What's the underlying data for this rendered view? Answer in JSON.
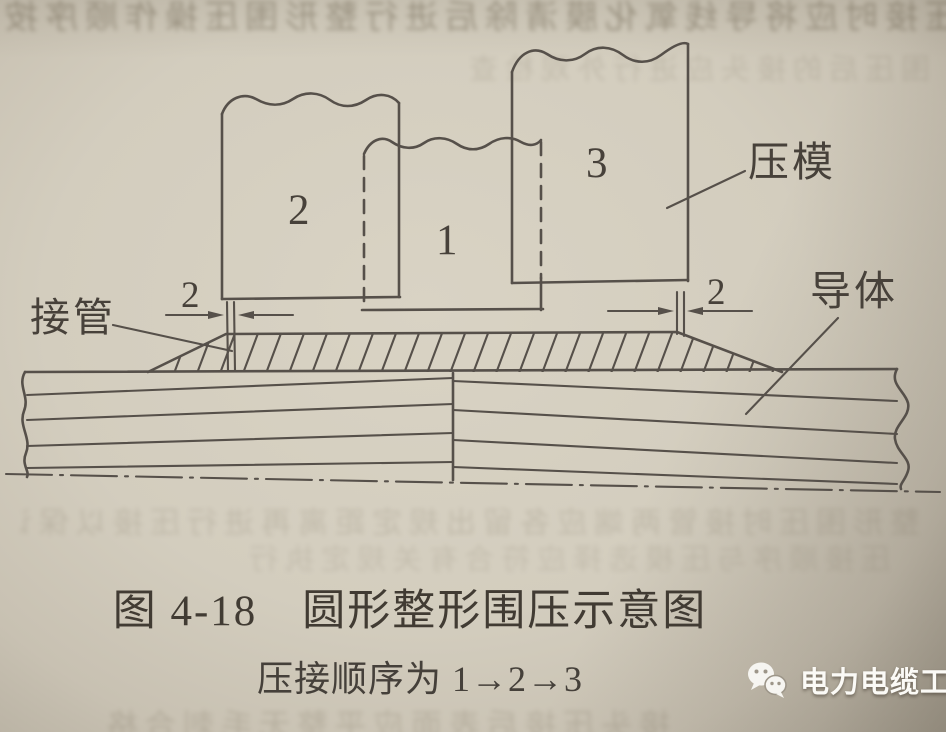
{
  "figure": {
    "caption": "图 4-18　圆形整形围压示意图",
    "subcaption": "压接顺序为 1→2→3"
  },
  "diagram": {
    "labels": {
      "die": "压模",
      "tube": "接管",
      "conductor": "导体"
    },
    "dies": [
      {
        "label": "1"
      },
      {
        "label": "2"
      },
      {
        "label": "3"
      }
    ],
    "dimensions": {
      "left_gap": "2",
      "right_gap": "2"
    }
  },
  "watermark": {
    "text": "电力电缆工",
    "icon": "wechat"
  },
  "colors": {
    "paper": "#d3cdbe",
    "ink": "#56504a",
    "caption_ink": "#413b33",
    "watermark_text": "#fbfaf6"
  },
  "bleed": {
    "rows": [
      "压接时应将导线氧化膜清除后进行整形围压操作顺序按图示要求执行压接",
      "围压后的接头应进行外观检查",
      "整形围压时接管两端应各留出规定距离再进行压接以保证接头质量要求",
      "压接顺序与压模选择应符合有关规定执行",
      "接头压接后表面应平整无毛刺合格"
    ]
  }
}
